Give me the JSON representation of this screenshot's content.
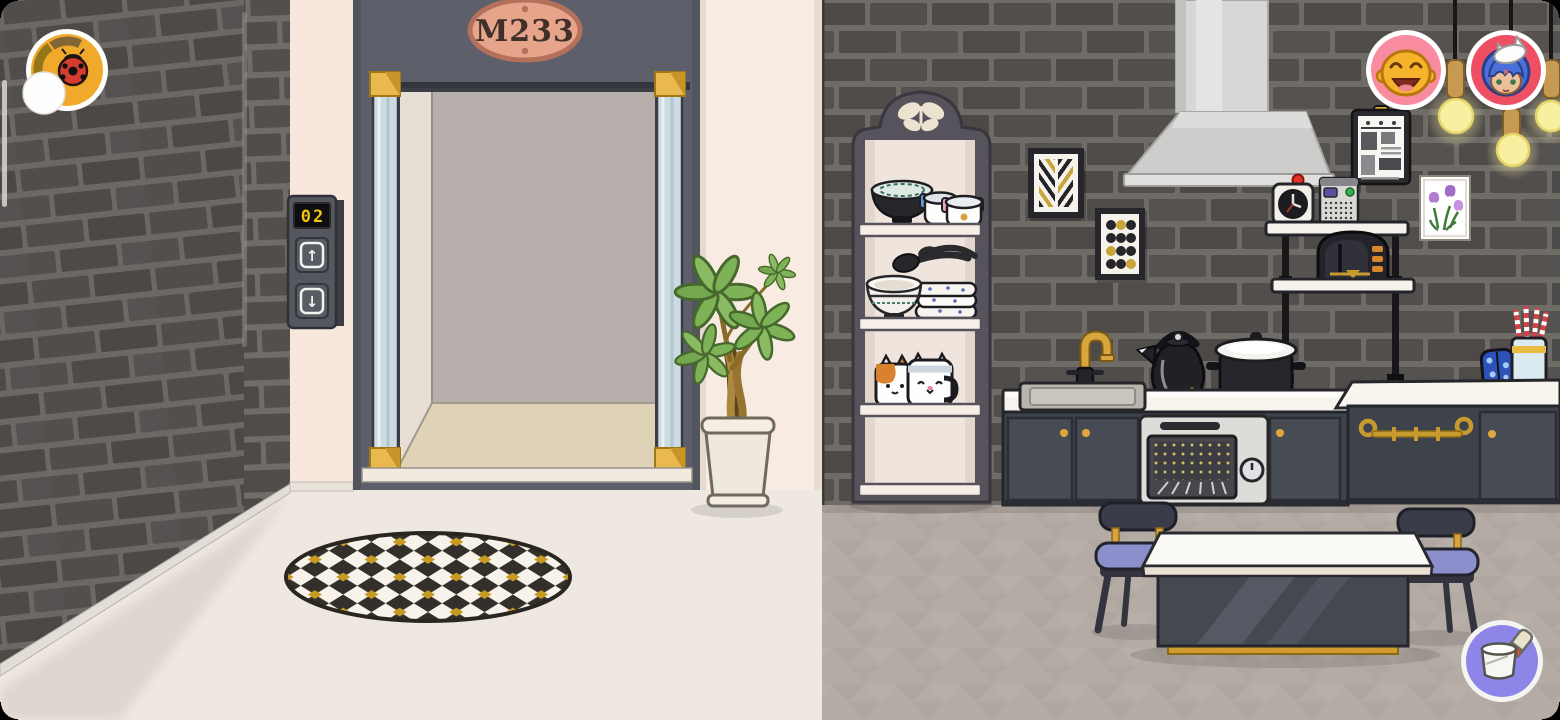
{
  "hud": {
    "map_button": {
      "icon": "ladybug-map-icon"
    },
    "notification_circle": {
      "icon": "blank-white-circle"
    },
    "profile_buttons": [
      {
        "icon": "yellow-laughing-avatar",
        "ring_color": "#f98ba0"
      },
      {
        "icon": "blue-hair-cat-hat-avatar",
        "ring_color": "#ee4f63"
      }
    ],
    "customize_button": {
      "icon": "paint-bucket-icon",
      "color": "#8d86e8"
    },
    "drag_handle": {
      "icon": "scroll-handle"
    }
  },
  "elevator": {
    "plaque": "M233",
    "floor_display": "02",
    "up_symbol": "↑",
    "down_symbol": "↓"
  },
  "room": {
    "objects": [
      "elevator",
      "call-panel",
      "potted-plant",
      "checkered-rug",
      "butterfly-shelf",
      "dish-bowl",
      "plate-stack",
      "cat-mugs",
      "chevron-art",
      "dots-art",
      "range-hood",
      "wall-clock",
      "radio",
      "toaster",
      "clipboard",
      "tulip-frame",
      "sink",
      "gold-faucet",
      "kettle",
      "stock-pot",
      "oven",
      "cabinets",
      "oven-mitt",
      "utensil-cup",
      "dining-table",
      "chairs",
      "hanging-bulbs"
    ]
  },
  "colors": {
    "brick": "#514e4b",
    "grout": "#6f6b67",
    "slate_wall": "#5d606a",
    "cream_wall": "#f7e9e0",
    "lobby_floor": "#efe8e1",
    "kitchen_floor": "#b2aaa3",
    "counter_top": "#f7f4ee",
    "cabinet": "#3e424b",
    "accent_gold": "#d8a33c",
    "avatar_pink": "#f98ba0",
    "avatar_red": "#ee4f63",
    "button_gold": "#f0a92b",
    "button_purple": "#8d86e8",
    "bulb_yellow": "#f8f0a0",
    "display_digits": "#f2c40e",
    "plaque_copper": "#e6a58b"
  }
}
